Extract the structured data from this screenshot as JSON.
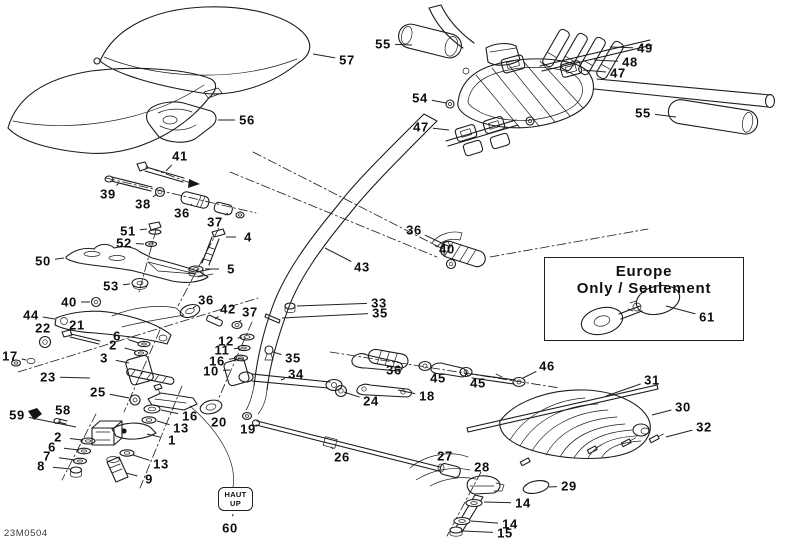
{
  "doc_code": "23M0504",
  "europe_box": {
    "line1": "Europe",
    "line2": "Only / Seulement"
  },
  "haut_tag": {
    "line1": "HAUT",
    "line2": "UP"
  },
  "colors": {
    "line": "#1c1c1c",
    "text": "#0e0e0e",
    "background": "#ffffff"
  },
  "callouts": [
    {
      "t": "55",
      "x": 383,
      "y": 44,
      "lx": 412,
      "ly": 45
    },
    {
      "t": "57",
      "x": 347,
      "y": 60,
      "lx": 313,
      "ly": 54
    },
    {
      "t": "56",
      "x": 247,
      "y": 120,
      "lx": 218,
      "ly": 120
    },
    {
      "t": "49",
      "x": 645,
      "y": 48,
      "lx": 610,
      "ly": 47
    },
    {
      "t": "48",
      "x": 630,
      "y": 62,
      "lx": 594,
      "ly": 60
    },
    {
      "t": "47",
      "x": 618,
      "y": 73,
      "lx": 583,
      "ly": 70
    },
    {
      "t": "54",
      "x": 420,
      "y": 98,
      "lx": 446,
      "ly": 103
    },
    {
      "t": "47",
      "x": 421,
      "y": 127,
      "lx": 449,
      "ly": 130
    },
    {
      "t": "55",
      "x": 643,
      "y": 113,
      "lx": 676,
      "ly": 117
    },
    {
      "t": "41",
      "x": 180,
      "y": 156,
      "lx": 166,
      "ly": 171
    },
    {
      "t": "39",
      "x": 108,
      "y": 194,
      "lx": 119,
      "ly": 183
    },
    {
      "t": "38",
      "x": 143,
      "y": 204,
      "lx": 157,
      "ly": 194
    },
    {
      "t": "36",
      "x": 182,
      "y": 213,
      "lx": 192,
      "ly": 204
    },
    {
      "t": "37",
      "x": 215,
      "y": 222,
      "lx": 228,
      "ly": 213
    },
    {
      "t": "51",
      "x": 128,
      "y": 231,
      "lx": 147,
      "ly": 229
    },
    {
      "t": "52",
      "x": 124,
      "y": 243,
      "lx": 144,
      "ly": 244
    },
    {
      "t": "4",
      "x": 248,
      "y": 237,
      "lx": 226,
      "ly": 237
    },
    {
      "t": "50",
      "x": 43,
      "y": 261,
      "lx": 64,
      "ly": 258
    },
    {
      "t": "5",
      "x": 231,
      "y": 269,
      "lx": 205,
      "ly": 269
    },
    {
      "t": "53",
      "x": 111,
      "y": 286,
      "lx": 130,
      "ly": 284
    },
    {
      "t": "36",
      "x": 414,
      "y": 230,
      "lx": 448,
      "ly": 246
    },
    {
      "t": "40",
      "x": 447,
      "y": 249,
      "lx": 451,
      "ly": 259
    },
    {
      "t": "43",
      "x": 362,
      "y": 267,
      "lx": 325,
      "ly": 248
    },
    {
      "t": "33",
      "x": 379,
      "y": 303,
      "lx": 297,
      "ly": 306
    },
    {
      "t": "35",
      "x": 380,
      "y": 313,
      "lx": 282,
      "ly": 318
    },
    {
      "t": "40",
      "x": 69,
      "y": 302,
      "lx": 90,
      "ly": 302
    },
    {
      "t": "44",
      "x": 31,
      "y": 315,
      "lx": 55,
      "ly": 319
    },
    {
      "t": "22",
      "x": 43,
      "y": 328,
      "lx": 45,
      "ly": 338
    },
    {
      "t": "21",
      "x": 77,
      "y": 325,
      "lx": 80,
      "ly": 334
    },
    {
      "t": "6",
      "x": 117,
      "y": 336,
      "lx": 139,
      "ly": 343
    },
    {
      "t": "2",
      "x": 113,
      "y": 345,
      "lx": 136,
      "ly": 351
    },
    {
      "t": "17",
      "x": 10,
      "y": 356,
      "lx": 26,
      "ly": 360
    },
    {
      "t": "3",
      "x": 104,
      "y": 358,
      "lx": 129,
      "ly": 363
    },
    {
      "t": "23",
      "x": 48,
      "y": 377,
      "lx": 90,
      "ly": 378
    },
    {
      "t": "36",
      "x": 206,
      "y": 300,
      "lx": 193,
      "ly": 308
    },
    {
      "t": "42",
      "x": 228,
      "y": 309,
      "lx": 215,
      "ly": 319
    },
    {
      "t": "37",
      "x": 250,
      "y": 312,
      "lx": 239,
      "ly": 322
    },
    {
      "t": "12",
      "x": 226,
      "y": 341,
      "lx": 242,
      "ly": 337
    },
    {
      "t": "11",
      "x": 222,
      "y": 350,
      "lx": 240,
      "ly": 348
    },
    {
      "t": "16",
      "x": 217,
      "y": 361,
      "lx": 237,
      "ly": 358
    },
    {
      "t": "10",
      "x": 211,
      "y": 371,
      "lx": 230,
      "ly": 370
    },
    {
      "t": "35",
      "x": 293,
      "y": 358,
      "lx": 273,
      "ly": 352
    },
    {
      "t": "34",
      "x": 296,
      "y": 374,
      "lx": 281,
      "ly": 380
    },
    {
      "t": "25",
      "x": 98,
      "y": 392,
      "lx": 129,
      "ly": 398
    },
    {
      "t": "58",
      "x": 63,
      "y": 410,
      "lx": 60,
      "ly": 419
    },
    {
      "t": "59",
      "x": 17,
      "y": 415,
      "lx": 76,
      "ly": 427
    },
    {
      "t": "16",
      "x": 190,
      "y": 416,
      "lx": 161,
      "ly": 410
    },
    {
      "t": "13",
      "x": 181,
      "y": 428,
      "lx": 157,
      "ly": 421
    },
    {
      "t": "20",
      "x": 219,
      "y": 422,
      "lx": 214,
      "ly": 414
    },
    {
      "t": "19",
      "x": 248,
      "y": 429,
      "lx": 247,
      "ly": 420
    },
    {
      "t": "1",
      "x": 172,
      "y": 440,
      "lx": 147,
      "ly": 434
    },
    {
      "t": "2",
      "x": 58,
      "y": 437,
      "lx": 82,
      "ly": 440
    },
    {
      "t": "6",
      "x": 52,
      "y": 447,
      "lx": 79,
      "ly": 450
    },
    {
      "t": "7",
      "x": 47,
      "y": 456,
      "lx": 75,
      "ly": 460
    },
    {
      "t": "8",
      "x": 41,
      "y": 466,
      "lx": 71,
      "ly": 469
    },
    {
      "t": "13",
      "x": 161,
      "y": 464,
      "lx": 133,
      "ly": 455
    },
    {
      "t": "9",
      "x": 149,
      "y": 479,
      "lx": 126,
      "ly": 473
    },
    {
      "t": "24",
      "x": 371,
      "y": 401,
      "lx": 344,
      "ly": 392
    },
    {
      "t": "18",
      "x": 427,
      "y": 396,
      "lx": 398,
      "ly": 390
    },
    {
      "t": "36",
      "x": 394,
      "y": 370,
      "lx": 398,
      "ly": 362
    },
    {
      "t": "45",
      "x": 438,
      "y": 378,
      "lx": 428,
      "ly": 369
    },
    {
      "t": "45",
      "x": 478,
      "y": 383,
      "lx": 466,
      "ly": 374
    },
    {
      "t": "46",
      "x": 547,
      "y": 366,
      "lx": 523,
      "ly": 378
    },
    {
      "t": "26",
      "x": 342,
      "y": 457,
      "lx": 331,
      "ly": 447
    },
    {
      "t": "27",
      "x": 445,
      "y": 456,
      "lx": 448,
      "ly": 465
    },
    {
      "t": "28",
      "x": 482,
      "y": 467,
      "lx": 480,
      "ly": 478
    },
    {
      "t": "29",
      "x": 569,
      "y": 486,
      "lx": 549,
      "ly": 487
    },
    {
      "t": "14",
      "x": 523,
      "y": 503,
      "lx": 484,
      "ly": 502
    },
    {
      "t": "14",
      "x": 510,
      "y": 524,
      "lx": 471,
      "ly": 521
    },
    {
      "t": "15",
      "x": 505,
      "y": 533,
      "lx": 463,
      "ly": 531
    },
    {
      "t": "31",
      "x": 652,
      "y": 380,
      "lx": 606,
      "ly": 396
    },
    {
      "t": "30",
      "x": 683,
      "y": 407,
      "lx": 652,
      "ly": 415
    },
    {
      "t": "32",
      "x": 704,
      "y": 427,
      "lx": 666,
      "ly": 437
    },
    {
      "t": "61",
      "x": 707,
      "y": 317,
      "lx": 666,
      "ly": 306
    },
    {
      "t": "60",
      "x": 230,
      "y": 528,
      "lx": 233,
      "ly": 514
    }
  ]
}
